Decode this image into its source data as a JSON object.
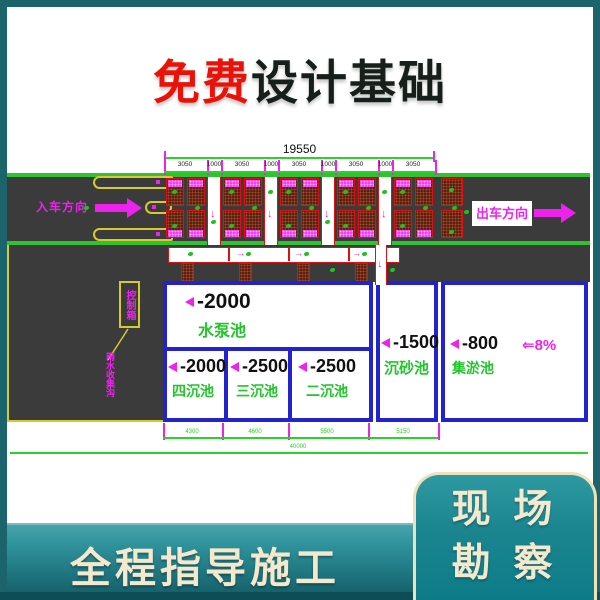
{
  "title": {
    "highlight": "免费",
    "rest": "设计基础"
  },
  "plan": {
    "dim_total_top": "19550",
    "dim_segments_top": [
      "3050",
      "1000",
      "3050",
      "1000",
      "3050",
      "1000",
      "3050",
      "1000",
      "3050"
    ],
    "entry_direction": "入车方向",
    "exit_direction": "出车方向",
    "control_box": "控制箱",
    "drain_note": "雨水收集沟",
    "slope": "⇐8%",
    "tanks": [
      {
        "depth": "-2000",
        "name": "水泵池"
      },
      {
        "depth": "-2000",
        "name": "四沉池"
      },
      {
        "depth": "-2500",
        "name": "三沉池"
      },
      {
        "depth": "-2500",
        "name": "二沉池"
      },
      {
        "depth": "-1500",
        "name": "沉砂池"
      },
      {
        "depth": "-800",
        "name": "集淤池"
      }
    ],
    "dim_segments_bottom": [
      "4300",
      "4600",
      "5500",
      "5150"
    ],
    "dim_total_bottom": "40000",
    "icons": {
      "down_arrow": "↓",
      "right_arrow": "→"
    },
    "colors": {
      "road": "#3b3b3b",
      "edge_green": "#2fc42f",
      "tank_border": "#2222cf",
      "magenta": "#ee22ee",
      "hatch_red": "#e01010",
      "island_yellow": "#d6cb2d",
      "frame_teal": "#1c646c",
      "cream": "#f5e9cd",
      "title_red": "#ea1208"
    }
  },
  "footer": {
    "band_text": "全程指导施工",
    "card_line1": "现 场",
    "card_line2": "勘 察"
  }
}
